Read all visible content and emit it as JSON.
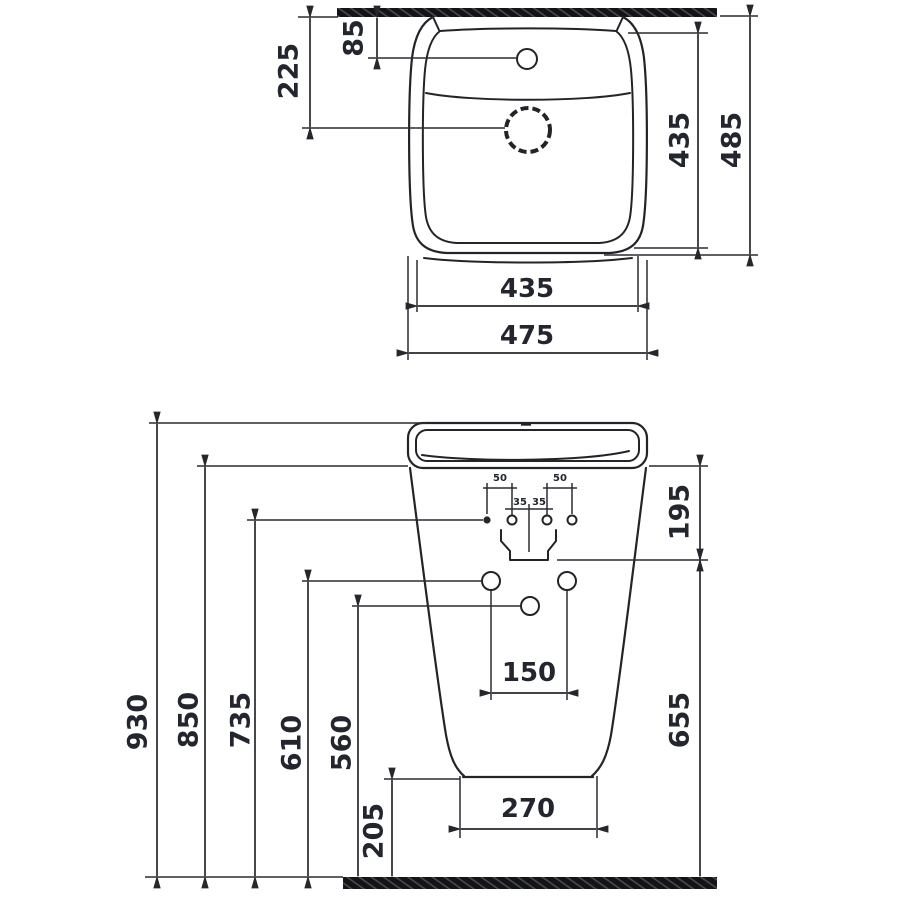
{
  "drawing": {
    "type": "washbasin-installation-dimensions",
    "colors": {
      "line": "#232428",
      "text": "#23262e",
      "hatch": "#131417"
    },
    "top_view": {
      "tap_hole_from_wall": "85",
      "drain_from_wall": "225",
      "inner_depth": "435",
      "outer_depth": "485",
      "inner_width": "435",
      "outer_width": "475"
    },
    "front_view": {
      "total_height": "930",
      "rim_underside_height": "850",
      "fixing_template_height": "735",
      "side_holes_height": "610",
      "center_hole_height": "560",
      "bottom_clearance": "205",
      "rim_depth": "195",
      "body_height": "655",
      "side_hole_spacing": "150",
      "base_width": "270",
      "fixing_left": "50",
      "fixing_right": "50",
      "fixing_inner_left": "35",
      "fixing_inner_right": "35"
    }
  }
}
